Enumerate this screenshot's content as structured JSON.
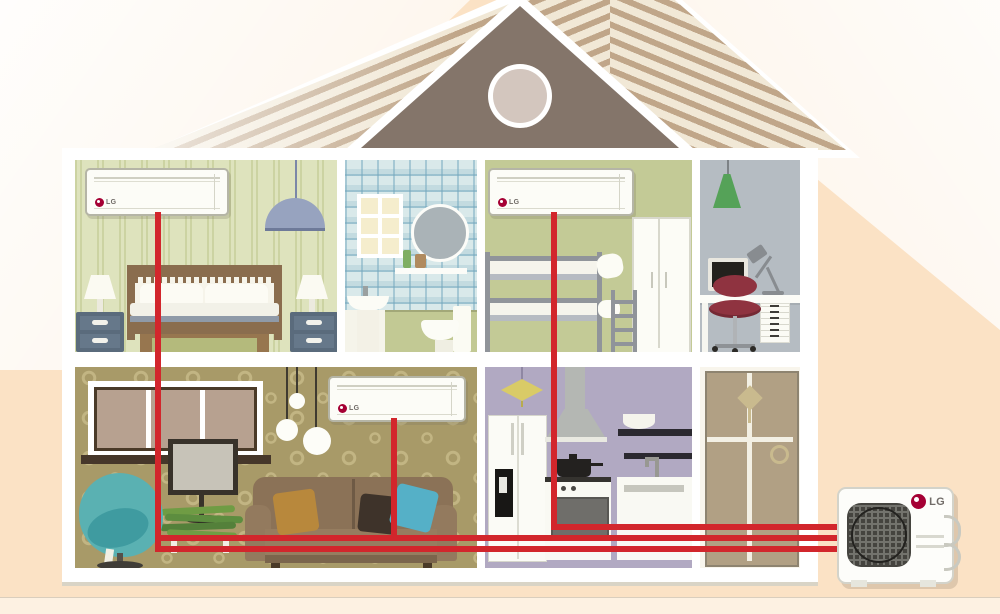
{
  "brand": {
    "name": "LG",
    "logo_red": "#a50034",
    "text_gray": "#6f6a66"
  },
  "ac_system": {
    "pipe_color": "#d2262c",
    "indoor_units": [
      {
        "location": "bedroom",
        "brand_label": "LG"
      },
      {
        "location": "kids-bunk-room",
        "brand_label": "LG"
      },
      {
        "location": "living-room",
        "brand_label": "LG"
      }
    ],
    "outdoor_unit": {
      "location": "outside-bottom-right",
      "brand_label": "LG"
    }
  },
  "house": {
    "floors": 2,
    "rooms": [
      {
        "id": "bedroom",
        "floor": "upper",
        "wall_color": "#dee3bd"
      },
      {
        "id": "bathroom",
        "floor": "upper",
        "wall_color": "#d9e9ea"
      },
      {
        "id": "kids-bunk-room",
        "floor": "upper",
        "wall_color": "#c3ca96"
      },
      {
        "id": "office",
        "floor": "upper",
        "wall_color": "#b5bcc2"
      },
      {
        "id": "living-room",
        "floor": "lower",
        "wall_color": "#a89a68"
      },
      {
        "id": "kitchen",
        "floor": "lower",
        "wall_color": "#b1a9c2"
      },
      {
        "id": "entry-door-room",
        "floor": "lower",
        "wall_color": "#f8f5ec"
      }
    ]
  },
  "palette": {
    "background": "#fbe2c5",
    "roof_stripe": "#c0a689",
    "roof_light": "#f1e8d6",
    "gable": "#84756a",
    "house_frame": "#ffffff"
  }
}
